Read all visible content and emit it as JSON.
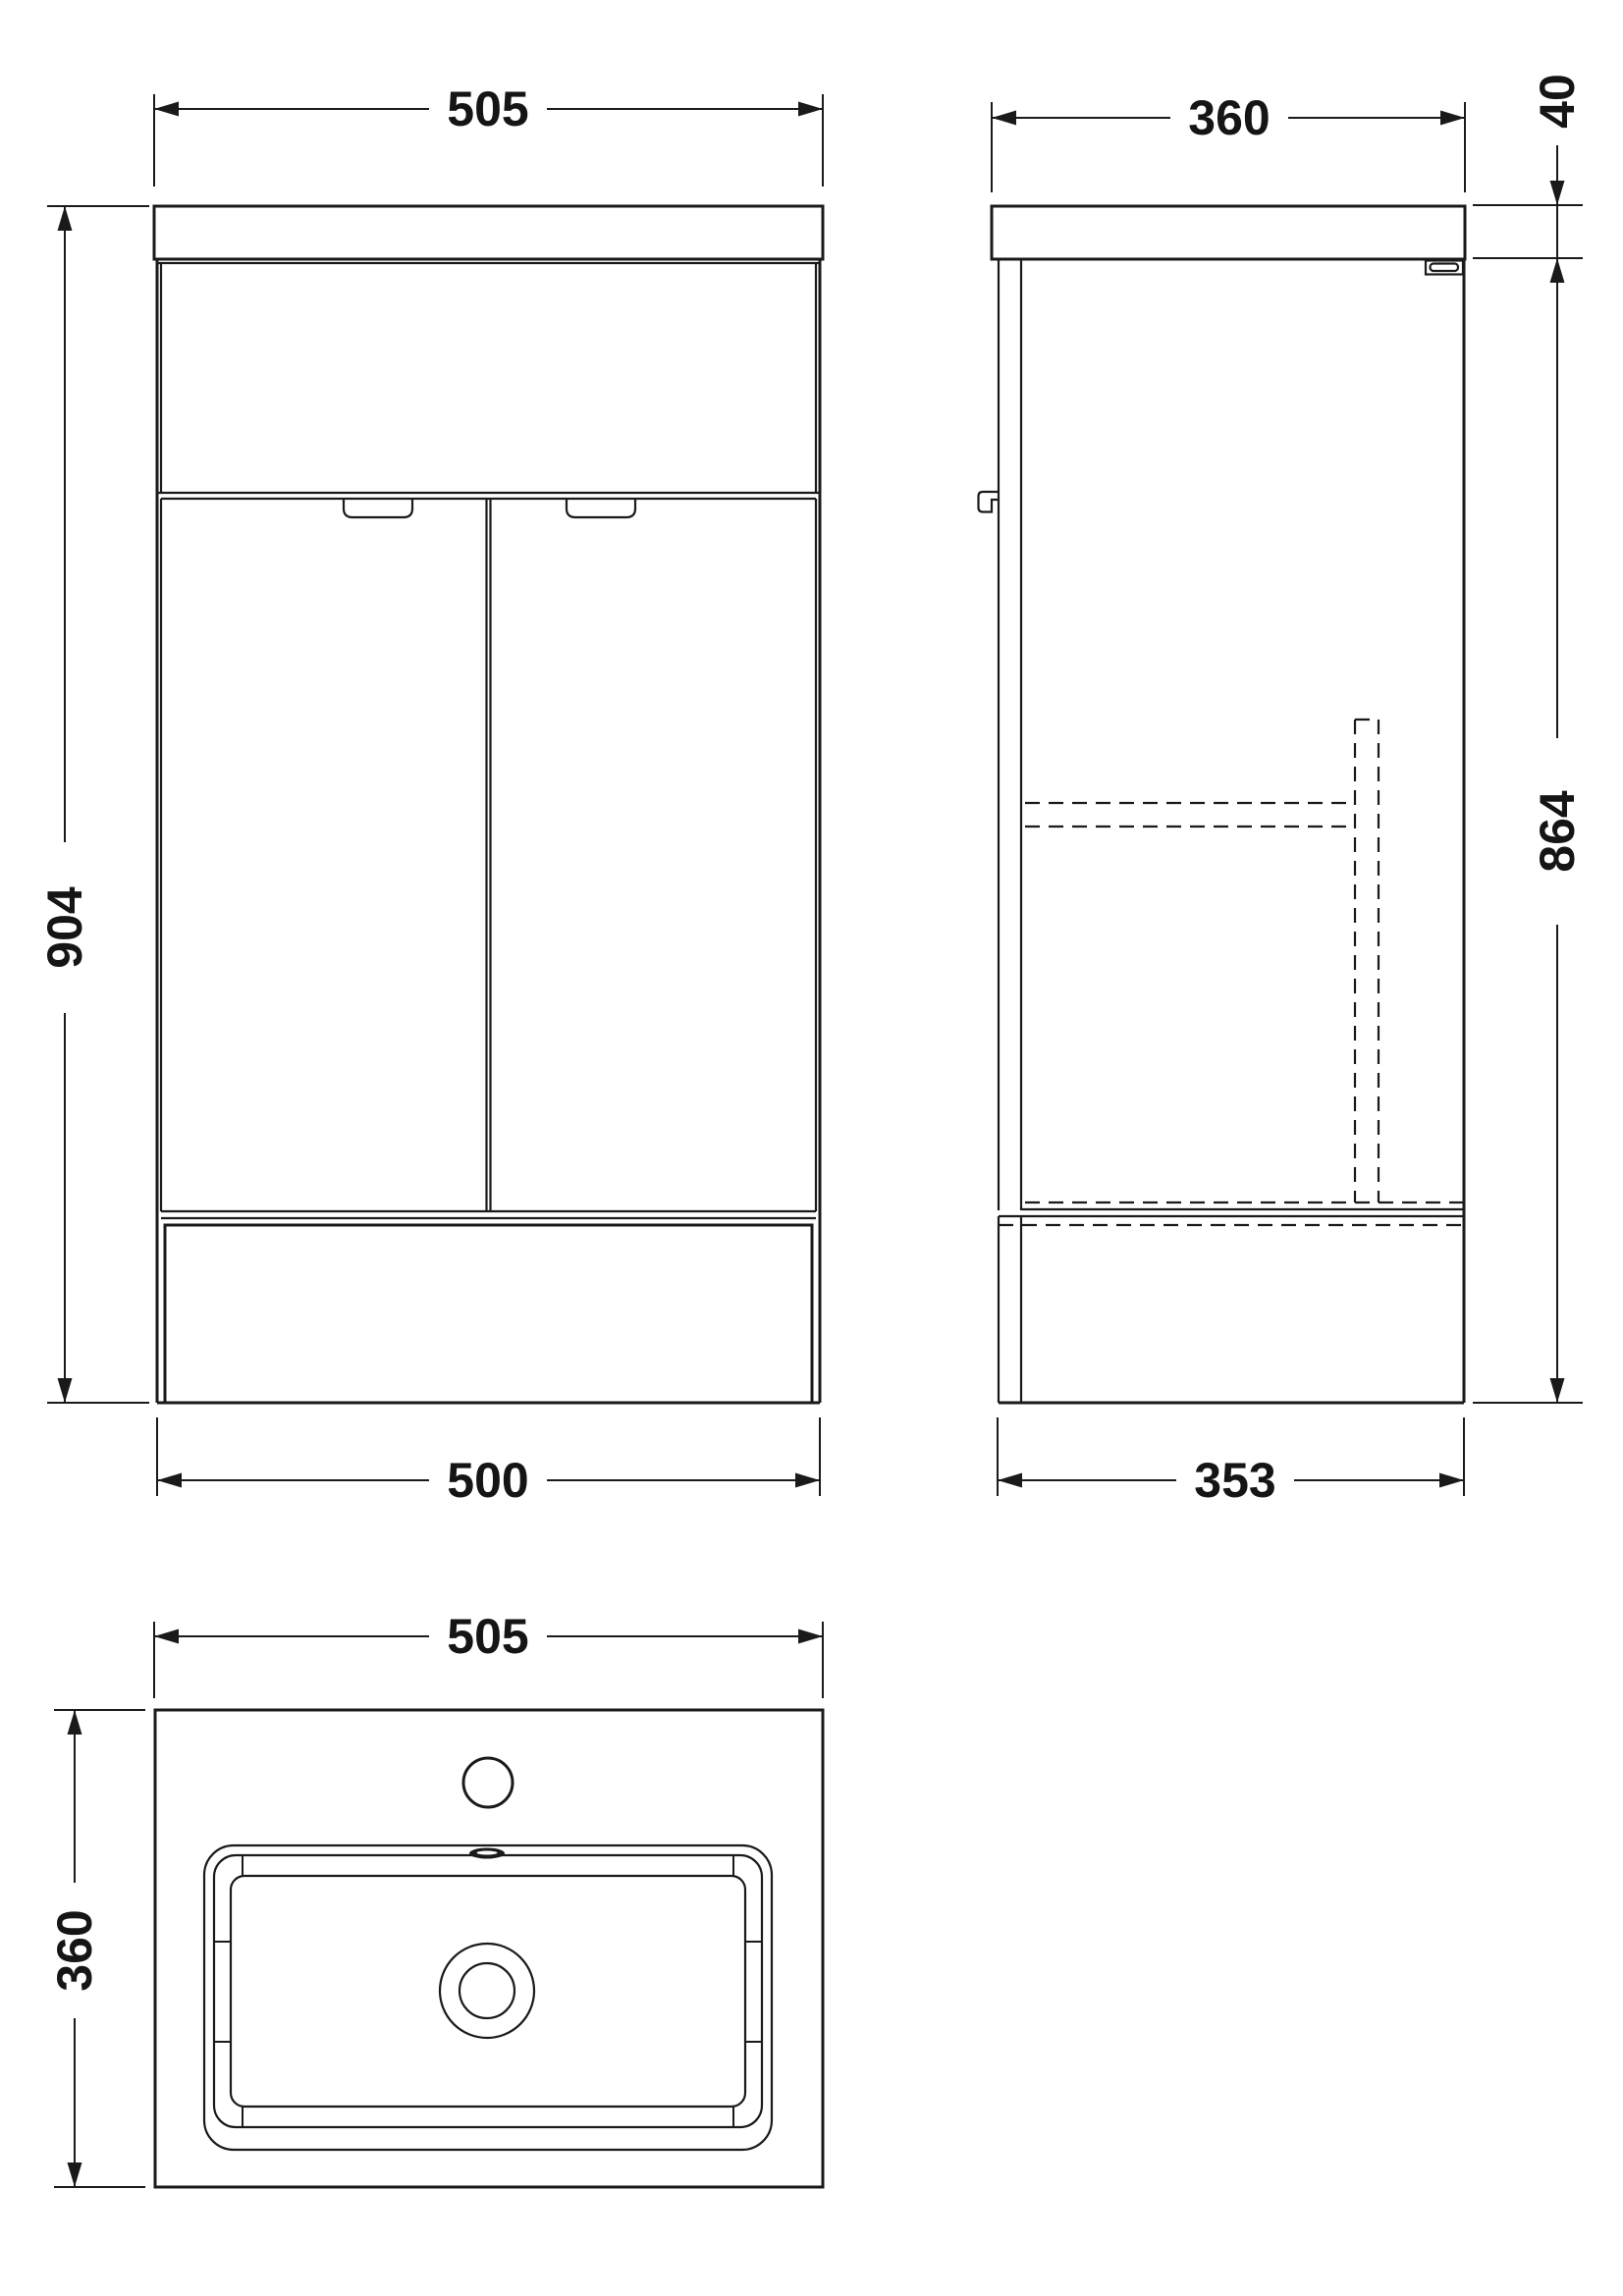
{
  "drawing": {
    "type": "vanity-unit-technical-drawing",
    "line_color": "#1a1a1a",
    "background": "#ffffff",
    "views": {
      "front_elevation": {
        "width_top": "505",
        "height_overall": "904",
        "width_bottom": "500"
      },
      "side_elevation": {
        "depth_top": "360",
        "worktop_thickness": "40",
        "cabinet_height": "864",
        "depth_bottom": "353"
      },
      "plan": {
        "width": "505",
        "depth": "360"
      }
    }
  }
}
